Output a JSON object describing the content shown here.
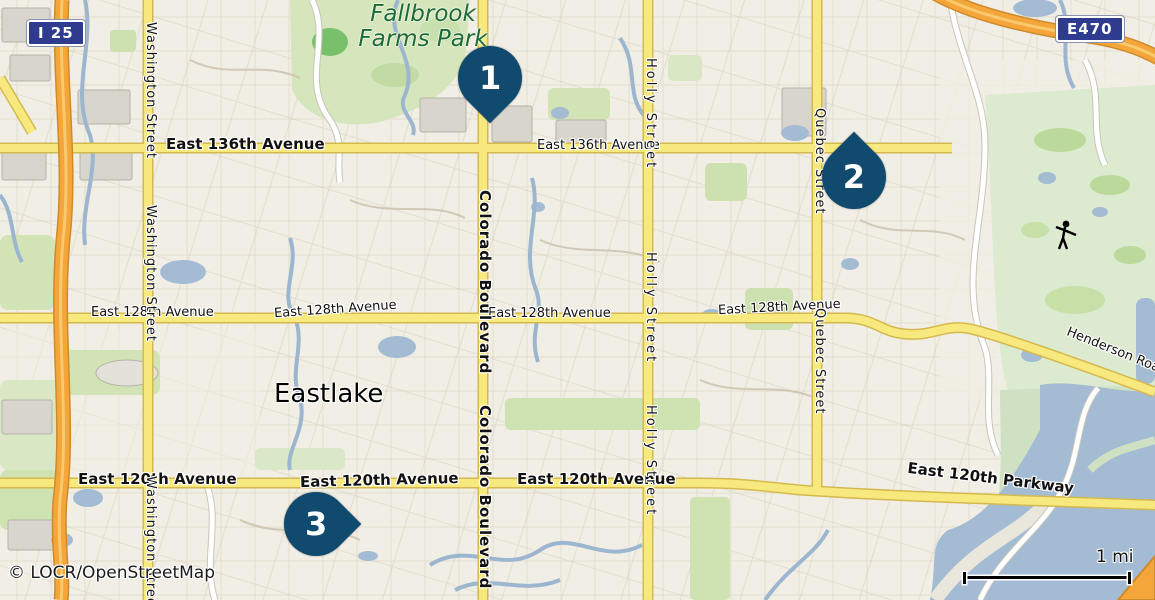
{
  "map": {
    "attribution": "© LOCR/OpenStreetMap",
    "scale": {
      "label": "1 mi"
    },
    "town": {
      "eastlake": "Eastlake"
    },
    "park": {
      "line1": "Fallbrook",
      "line2": "Farms Park"
    },
    "shields": {
      "i25": "I 25",
      "e470": "E470"
    },
    "streets": {
      "east_136th_avenue": "East 136th Avenue",
      "east_128th_avenue": "East 128th Avenue",
      "east_120th_avenue": "East 120th Avenue",
      "east_120th_parkway": "East 120th Parkway",
      "henderson_road": "Henderson Road",
      "washington_street": "Washington Street",
      "colorado_boulevard": "Colorado Boulevard",
      "holly_street": "Holly Street",
      "quebec_street": "Quebec Street"
    },
    "markers": [
      {
        "number": "1"
      },
      {
        "number": "2"
      },
      {
        "number": "3"
      }
    ],
    "colors": {
      "marker": "#114a6f",
      "road_major": "#f8e97e",
      "highway": "#f4a63a",
      "water": "#a3bbd3",
      "park_green": "#d6e6bc",
      "shield_blue": "#2e3b8f",
      "park_label_green": "#1e6b37"
    }
  }
}
